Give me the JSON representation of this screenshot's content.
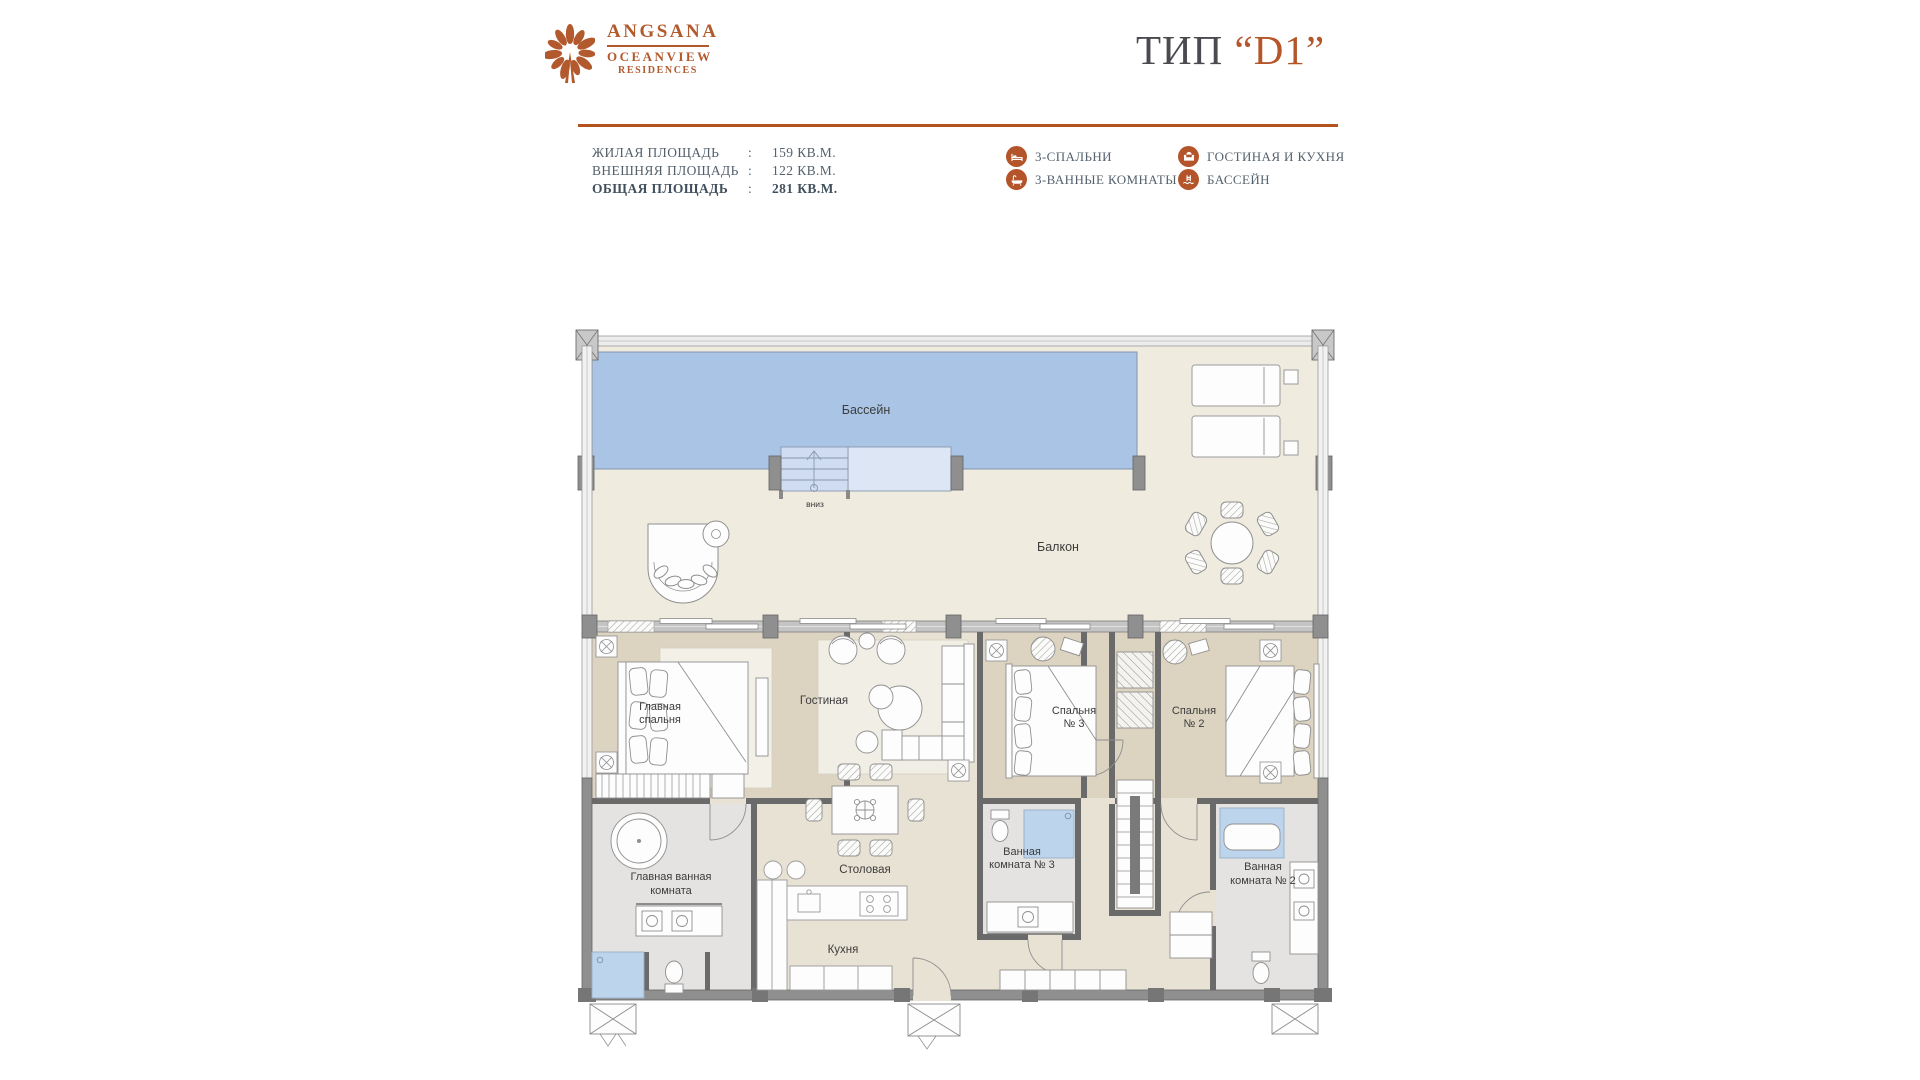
{
  "brand": {
    "name": "ANGSANA",
    "line2": "OCEANVIEW",
    "line3": "RESIDENCES"
  },
  "title": {
    "prefix": "ТИП",
    "code": "“D1”"
  },
  "areas": [
    {
      "label": "ЖИЛАЯ ПЛОЩАДЬ",
      "sep": ":",
      "value": "159 КВ.М."
    },
    {
      "label": "ВНЕШНЯЯ ПЛОЩАДЬ",
      "sep": ":",
      "value": "122 КВ.М."
    },
    {
      "label": "ОБЩАЯ ПЛОЩАДЬ",
      "sep": ":",
      "value": "281 КВ.М."
    }
  ],
  "legend": [
    {
      "icon": "bed-icon",
      "label": "3-СПАЛЬНИ"
    },
    {
      "icon": "bathtub-icon",
      "label": "3-ВАННЫЕ КОМНАТЫ"
    },
    {
      "icon": "sofa-icon",
      "label": "ГОСТИНАЯ И КУХНЯ"
    },
    {
      "icon": "pool-icon",
      "label": "БАССЕЙН"
    }
  ],
  "plan": {
    "labels": {
      "pool": "Бассейн",
      "down": "вниз",
      "balcony": "Балкон",
      "master_bedroom": [
        "Главная",
        "спальня"
      ],
      "living": "Гостиная",
      "bedroom3": [
        "Спальня",
        "№ 3"
      ],
      "bedroom2": [
        "Спальня",
        "№ 2"
      ],
      "master_bath": [
        "Главная ванная",
        "комната"
      ],
      "dining": "Столовая",
      "bath3": [
        "Ванная",
        "комната № 3"
      ],
      "bath2": [
        "Ванная",
        "комната № 2"
      ],
      "kitchen": "Кухня"
    }
  },
  "colors": {
    "accent": "#b4552a",
    "divider": "#b4531d",
    "title_gray": "#4a4a4f",
    "info_text": "#54616d",
    "plan_label": "#3c3c3c",
    "pool": "#a9c4e4",
    "pool_light": "#dde6f5",
    "terrace_floor": "#efebdf",
    "interior_floor": "#e8e2d4",
    "bedroom_floor": "#dcd3c1",
    "bath_floor": "#e4e3e1",
    "shower_blue": "#bcd4ec",
    "wall_gray": "#8f8f8f",
    "wall_dark": "#6a6a6a"
  }
}
